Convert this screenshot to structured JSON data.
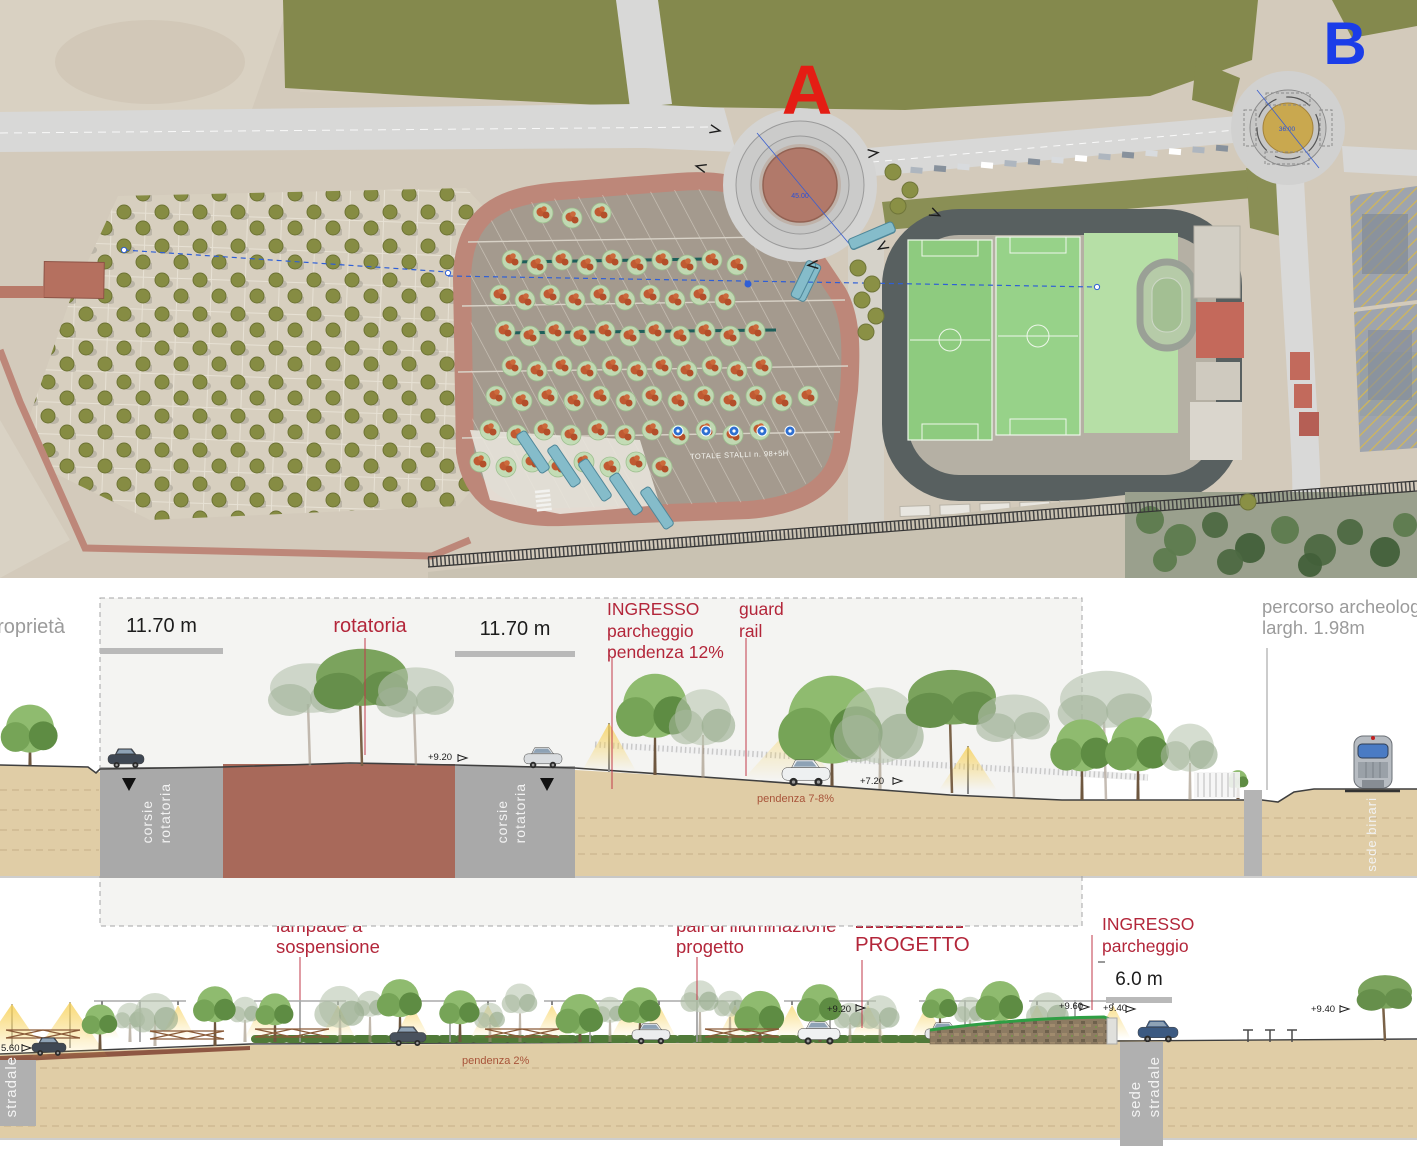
{
  "plan": {
    "marker_a": "A",
    "marker_b": "B",
    "roundabout_a_diameter": "45.00",
    "roundabout_b_diameter": "36.00",
    "parking_note": "TOTALE STALLI n. 98+5H",
    "colors": {
      "marker_a": "#e41d14",
      "marker_b": "#1b3de8",
      "ring_road": "#bd8779",
      "sport_ring": "#586060"
    }
  },
  "secA": {
    "proprieta": "proprietà",
    "dim_left": "11.70 m",
    "dim_right": "11.70 m",
    "rotatoria": "rotatoria",
    "ingresso": {
      "l1": "INGRESSO",
      "l2": "parcheggio",
      "l3": "pendenza 12%"
    },
    "guard": {
      "l1": "guard",
      "l2": "rail"
    },
    "percorso": {
      "l1": "percorso archeologico",
      "l2": "largh. 1.98m"
    },
    "elev_920": "+9.20",
    "elev_720": "+7.20",
    "pendenza": "pendenza 7-8%",
    "corsie": {
      "w1": "corsie",
      "w2": "rotatoria"
    },
    "sede_binari": "sede binari"
  },
  "secB": {
    "lampade": {
      "l1": "lampade a",
      "l2": "sospensione"
    },
    "pali": {
      "l1": "pali di illuminazione",
      "l2": "progetto"
    },
    "progetto": "PROGETTO",
    "ingresso": {
      "l1": "INGRESSO",
      "l2": "parcheggio"
    },
    "dim": "6.0 m",
    "pendenza": "pendenza 2%",
    "elevs": {
      "e920": "+9.20",
      "e960": "+9.60",
      "e940a": "+9.40",
      "e940b": "+9.40",
      "e560": "5.60"
    },
    "sede_stradale": {
      "w1": "sede",
      "w2": "stradale"
    }
  }
}
